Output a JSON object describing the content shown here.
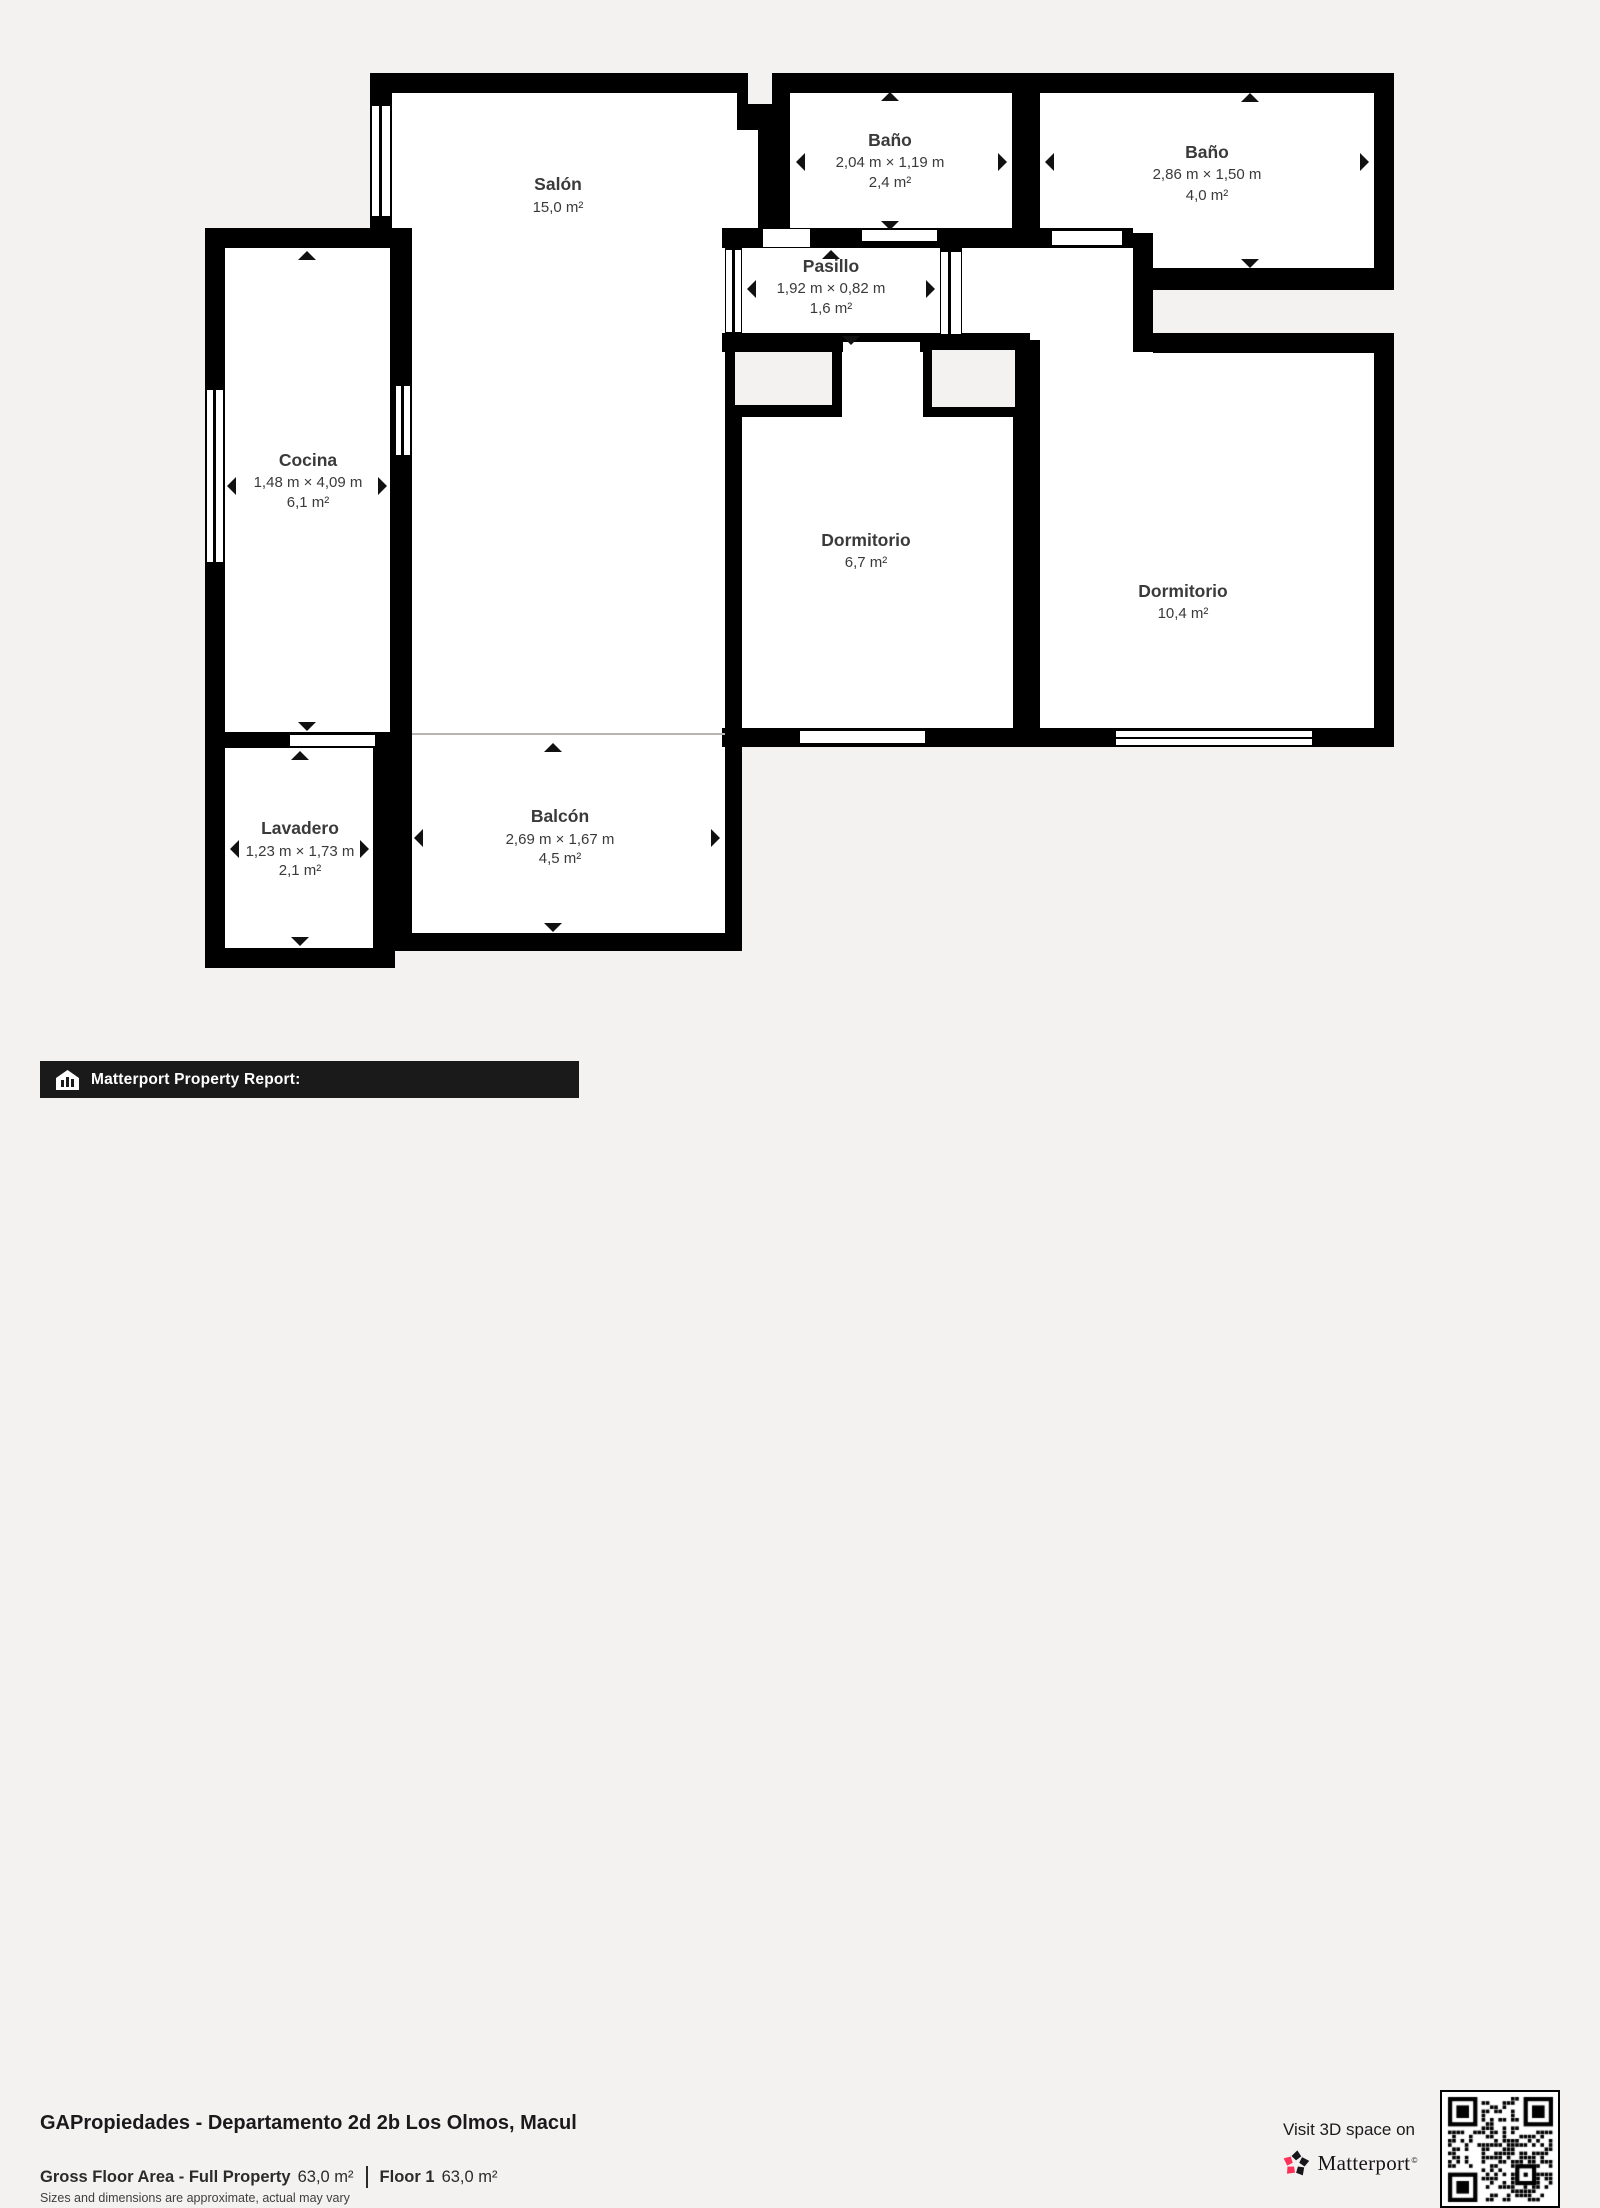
{
  "plan": {
    "rooms": {
      "salon": {
        "name": "Salón",
        "area": "15,0 m²"
      },
      "bano_small": {
        "name": "Baño",
        "dims": "2,04 m × 1,19 m",
        "area": "2,4 m²"
      },
      "bano_large": {
        "name": "Baño",
        "dims": "2,86 m × 1,50 m",
        "area": "4,0 m²"
      },
      "pasillo": {
        "name": "Pasillo",
        "dims": "1,92 m × 0,82 m",
        "area": "1,6 m²"
      },
      "cocina": {
        "name": "Cocina",
        "dims": "1,48 m × 4,09 m",
        "area": "6,1 m²"
      },
      "dormitorio_small": {
        "name": "Dormitorio",
        "area": "6,7 m²"
      },
      "dormitorio_large": {
        "name": "Dormitorio",
        "area": "10,4 m²"
      },
      "lavadero": {
        "name": "Lavadero",
        "dims": "1,23 m × 1,73 m",
        "area": "2,1 m²"
      },
      "balcon": {
        "name": "Balcón",
        "dims": "2,69 m × 1,67 m",
        "area": "4,5 m²"
      }
    }
  },
  "footer": {
    "report_label": "Matterport Property Report:",
    "property_title": "GAPropiedades - Departamento 2d 2b Los Olmos, Macul",
    "gross_floor_area_label": "Gross Floor Area - Full Property",
    "gross_floor_area_value": "63,0 m²",
    "floor_label": "Floor 1",
    "floor_value": "63,0 m²",
    "disclaimer": "Sizes and dimensions are approximate, actual may vary",
    "visit_text": "Visit 3D space on",
    "brand_name": "Matterport",
    "trademark": "©"
  },
  "colors": {
    "background": "#f4f2f0",
    "wall": "#000000",
    "room_fill": "#ffffff",
    "label_text": "#3a3a3a",
    "brand_pink": "#ff3158",
    "brand_black": "#17171b"
  }
}
